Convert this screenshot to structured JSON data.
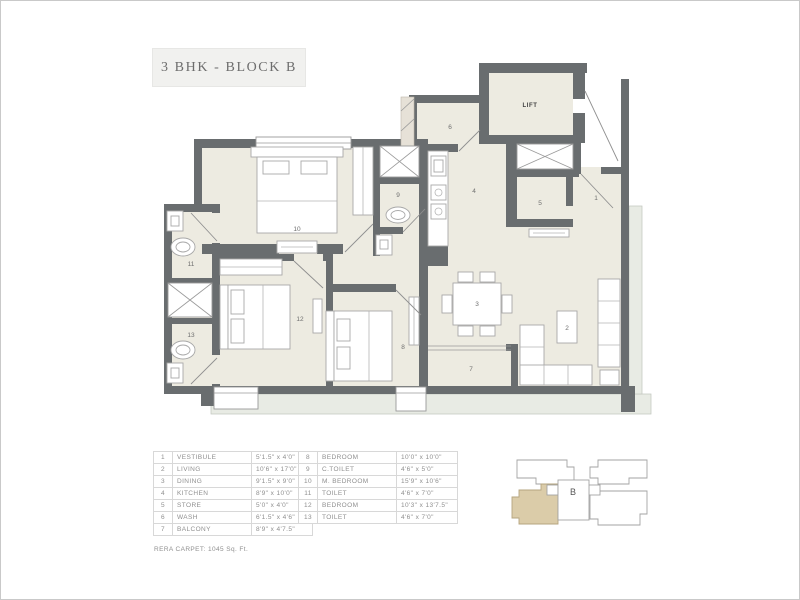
{
  "title": "3 BHK - BLOCK B",
  "plan": {
    "lift_label": "LIFT",
    "room_numbers": [
      "1",
      "2",
      "3",
      "4",
      "5",
      "6",
      "7",
      "8",
      "9",
      "10",
      "11",
      "12",
      "13"
    ]
  },
  "legend": {
    "left": [
      {
        "num": "1",
        "name": "VESTIBULE",
        "size": "5'1.5\" x 4'0\""
      },
      {
        "num": "2",
        "name": "LIVING",
        "size": "10'6\" x 17'0\""
      },
      {
        "num": "3",
        "name": "DINING",
        "size": "9'1.5\" x 9'0\""
      },
      {
        "num": "4",
        "name": "KITCHEN",
        "size": "8'9\" x 10'0\""
      },
      {
        "num": "5",
        "name": "STORE",
        "size": "5'0\" x 4'0\""
      },
      {
        "num": "6",
        "name": "WASH",
        "size": "6'1.5\" x 4'6\""
      },
      {
        "num": "7",
        "name": "BALCONY",
        "size": "8'9\" x 4'7.5\""
      }
    ],
    "right": [
      {
        "num": "8",
        "name": "BEDROOM",
        "size": "10'0\" x 10'0\""
      },
      {
        "num": "9",
        "name": "C.TOILET",
        "size": "4'6\" x 5'0\""
      },
      {
        "num": "10",
        "name": "M. BEDROOM",
        "size": "15'9\" x 10'6\""
      },
      {
        "num": "11",
        "name": "TOILET",
        "size": "4'6\" x 7'0\""
      },
      {
        "num": "12",
        "name": "BEDROOM",
        "size": "10'3\" x 13'7.5\""
      },
      {
        "num": "13",
        "name": "TOILET",
        "size": "4'6\" x 7'0\""
      }
    ],
    "note": "RERA CARPET: 1045 Sq. Ft."
  },
  "keyplan": {
    "block_label": "B"
  },
  "colors": {
    "wall": "#696d6f",
    "room_fill": "#edebe1",
    "ledge": "#e8ebe4",
    "highlight": "#dbcca9",
    "table_text": "#8f8f8f",
    "title_text": "#6d6d6d"
  }
}
